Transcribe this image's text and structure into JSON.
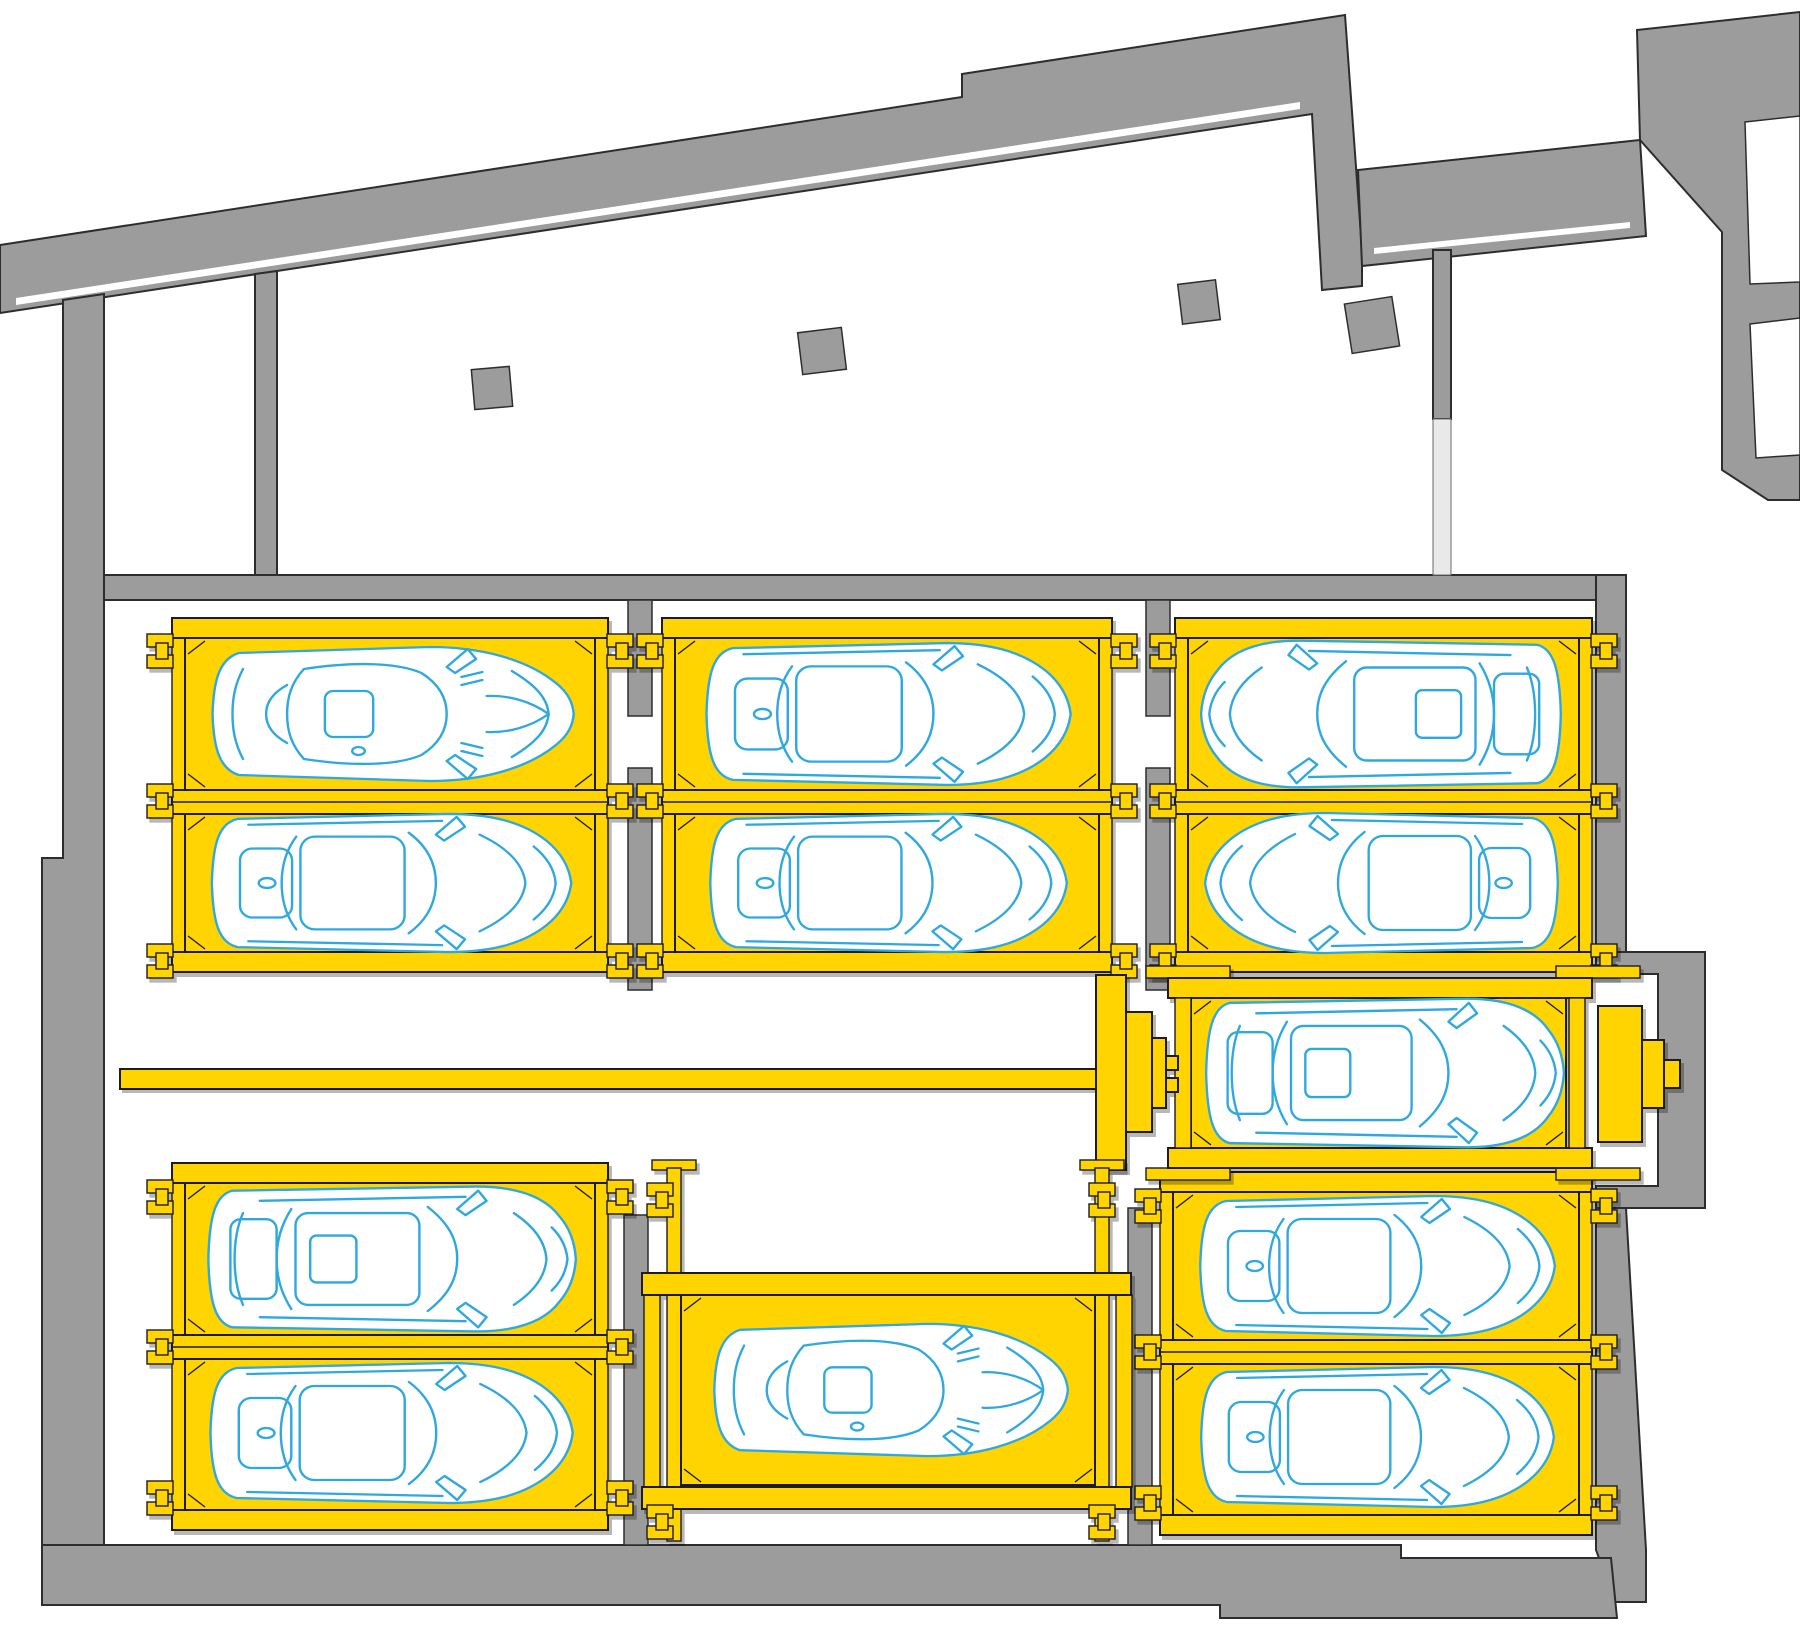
{
  "title": "automated-parking-system-floor-plan",
  "canvas": {
    "width": 1800,
    "height": 1641,
    "background": "#ffffff"
  },
  "colors": {
    "wall": "#9c9c9c",
    "wall_stroke": "#2d2d2d",
    "platform_yellow": "#ffd400",
    "platform_outline": "#1a1a1a",
    "car_line": "#2fa8df",
    "car_fill": "#ffffff",
    "door_opening": "#e9e9e9"
  },
  "structure": {
    "walls": [
      {
        "name": "perimeter-band-northwest",
        "points": "0,245 962,97 962,74 1345,15 1362,250 1362,286 1322,290 1312,114 0,313"
      },
      {
        "name": "band-north-horizontal",
        "points": "1358,170 1640,140 1646,236 1362,266"
      },
      {
        "name": "northeast-block",
        "points": "1637,30 1800,12 1800,500 1768,500 1722,470 1722,232 1640,140"
      },
      {
        "name": "niche-east-wall",
        "points": "255,274 277,271 277,600 255,600"
      },
      {
        "name": "west-wall",
        "points": "63,300 104,294 104,1605 42,1605 42,858 63,858"
      },
      {
        "name": "hall-north-wall",
        "points": "104,575 1596,575 1596,600 104,600"
      },
      {
        "name": "door-head-wall",
        "points": "1433,250 1451,250 1451,419 1433,419"
      },
      {
        "name": "east-wall-upper",
        "points": "1596,575 1626,575 1626,952 1596,952"
      },
      {
        "name": "east-wall-alcove",
        "points": "1596,952 1705,952 1705,1208 1596,1208 1596,1186 1658,1186 1658,974 1596,974"
      },
      {
        "name": "east-wall-lower",
        "points": "1596,1208 1626,1208 1646,1550 1646,1602 1615,1602 1596,1550"
      },
      {
        "name": "south-wall",
        "points": "42,1545 1401,1545 1401,1558 1611,1558 1617,1618 1220,1618 1220,1605 42,1605"
      }
    ],
    "wall_inner_lines": [
      {
        "name": "band-nw-inner-face",
        "points": "16,298 1300,102 1300,109 16,305"
      },
      {
        "name": "band-ne-inner-face",
        "points": "1374,248 1630,222 1630,228 1374,254"
      }
    ],
    "rooms": [
      {
        "name": "room-northeast-upper",
        "points": "1745,122 1800,116 1800,282 1750,284"
      },
      {
        "name": "room-northeast-lower",
        "points": "1750,324 1800,318 1800,455 1756,458"
      }
    ],
    "door_opening": {
      "x": 1433,
      "y": 419,
      "w": 18,
      "h": 156
    },
    "pillars": [
      [
        628,
        600,
        24,
        116
      ],
      [
        628,
        768,
        24,
        222
      ],
      [
        1146,
        600,
        24,
        116
      ],
      [
        1146,
        768,
        24,
        222
      ],
      [
        624,
        1215,
        24,
        330
      ],
      [
        1128,
        1208,
        24,
        337
      ]
    ],
    "tilted_columns": [
      [
        473,
        368,
        38,
        40,
        -5
      ],
      [
        800,
        330,
        44,
        42,
        -7
      ],
      [
        1180,
        282,
        38,
        40,
        -7
      ],
      [
        1348,
        300,
        48,
        50,
        -9
      ]
    ]
  },
  "parking": {
    "car_count": 12,
    "pallet_count": 12,
    "transfer_rail": {
      "x": 120,
      "y": 1069,
      "w": 984,
      "h": 20
    },
    "groups": [
      {
        "id": "upper-left",
        "x": 172,
        "w": 436,
        "top": [
          618,
          20
        ],
        "divider": [
          790,
          24
        ],
        "bottom": [
          952,
          20
        ],
        "rail_w": 13,
        "clamp_ys": [
          651,
          801,
          961
        ],
        "clamp_sides": [
          "left",
          "right"
        ]
      },
      {
        "id": "upper-middle",
        "x": 662,
        "w": 450,
        "top": [
          618,
          20
        ],
        "divider": [
          790,
          24
        ],
        "bottom": [
          952,
          20
        ],
        "rail_w": 13,
        "clamp_ys": [
          651,
          801,
          961
        ],
        "clamp_sides": [
          "left",
          "right"
        ]
      },
      {
        "id": "upper-right",
        "x": 1175,
        "w": 417,
        "top": [
          618,
          20
        ],
        "divider": [
          790,
          24
        ],
        "bottom": [
          952,
          20
        ],
        "rail_w": 13,
        "clamp_ys": [
          651,
          801,
          961
        ],
        "clamp_sides": [
          "left",
          "right"
        ]
      },
      {
        "id": "lower-left",
        "x": 172,
        "w": 436,
        "top": [
          1163,
          20
        ],
        "divider": [
          1335,
          24
        ],
        "bottom": [
          1510,
          20
        ],
        "rail_w": 13,
        "clamp_ys": [
          1197,
          1347,
          1498
        ],
        "clamp_sides": [
          "left",
          "right"
        ]
      },
      {
        "id": "lower-right",
        "x": 1160,
        "w": 432,
        "top": [
          1172,
          20
        ],
        "divider": [
          1340,
          24
        ],
        "bottom": [
          1515,
          20
        ],
        "rail_w": 13,
        "clamp_ys": [
          1206,
          1352,
          1503
        ],
        "clamp_sides": [
          "left",
          "right"
        ]
      }
    ],
    "transfer_platform": {
      "id": "transfer-platform",
      "x": 1168,
      "w": 424,
      "top_bar": [
        978,
        20
      ],
      "bottom_bar": [
        1148,
        20
      ],
      "rail_w": 16,
      "pallet": [
        1191,
        998,
        375,
        150
      ],
      "plates": [
        [
          1146,
          966,
          84,
          12
        ],
        [
          1146,
          1168,
          84,
          12
        ],
        [
          1556,
          966,
          84,
          12
        ],
        [
          1556,
          1168,
          84,
          12
        ]
      ]
    },
    "lower_middle_platform": {
      "id": "lower-middle",
      "posts": [
        [
          667,
          1168,
          14,
          373
        ],
        [
          1095,
          1168,
          14,
          373
        ]
      ],
      "post_caps": [
        [
          652,
          1160,
          44,
          10
        ],
        [
          1080,
          1160,
          44,
          10
        ]
      ],
      "cross_bars": [
        [
          642,
          1273,
          489,
          22
        ],
        [
          642,
          1487,
          489,
          22
        ]
      ],
      "side_plates": [
        [
          644,
          1295,
          16,
          192
        ],
        [
          1116,
          1295,
          16,
          192
        ]
      ],
      "pallet": [
        681,
        1295,
        414,
        190
      ],
      "clamps": [
        [
          660,
          1200
        ],
        [
          1102,
          1200
        ],
        [
          660,
          1522
        ],
        [
          1102,
          1522
        ]
      ]
    },
    "machinery": {
      "left_blocks": [
        [
          1096,
          975,
          30,
          195
        ],
        [
          1126,
          1012,
          26,
          120
        ],
        [
          1152,
          1038,
          14,
          70
        ],
        [
          1166,
          1056,
          12,
          14
        ],
        [
          1166,
          1078,
          12,
          14
        ]
      ],
      "right_blocks": [
        [
          1598,
          1006,
          44,
          136
        ],
        [
          1642,
          1040,
          22,
          68
        ],
        [
          1664,
          1060,
          16,
          28
        ]
      ]
    },
    "cars": [
      {
        "id": "car-1",
        "group": "upper-left",
        "type": "sport",
        "cx": 390,
        "cy": 714,
        "dir": "right",
        "length": 378,
        "width": 150
      },
      {
        "id": "car-2",
        "group": "upper-left",
        "type": "sedan",
        "cx": 390,
        "cy": 883,
        "dir": "right",
        "length": 375,
        "width": 148
      },
      {
        "id": "car-3",
        "group": "upper-middle",
        "type": "sedan",
        "cx": 887,
        "cy": 714,
        "dir": "right",
        "length": 380,
        "width": 152
      },
      {
        "id": "car-4",
        "group": "upper-middle",
        "type": "sedan",
        "cx": 887,
        "cy": 883,
        "dir": "right",
        "length": 372,
        "width": 148
      },
      {
        "id": "car-5",
        "group": "upper-right",
        "type": "suv",
        "cx": 1383,
        "cy": 714,
        "dir": "left",
        "length": 370,
        "width": 155
      },
      {
        "id": "car-6",
        "group": "upper-right",
        "type": "sedan",
        "cx": 1383,
        "cy": 883,
        "dir": "left",
        "length": 368,
        "width": 150
      },
      {
        "id": "car-7",
        "group": "transfer-platform",
        "type": "suv",
        "cx": 1383,
        "cy": 1073,
        "dir": "right",
        "length": 368,
        "width": 157
      },
      {
        "id": "car-8",
        "group": "lower-left",
        "type": "suv",
        "cx": 390,
        "cy": 1259,
        "dir": "right",
        "length": 378,
        "width": 153
      },
      {
        "id": "car-9",
        "group": "lower-left",
        "type": "sedan",
        "cx": 390,
        "cy": 1433,
        "dir": "right",
        "length": 378,
        "width": 150
      },
      {
        "id": "car-10",
        "group": "lower-middle",
        "type": "sport",
        "cx": 888,
        "cy": 1390,
        "dir": "right",
        "length": 370,
        "width": 148
      },
      {
        "id": "car-11",
        "group": "lower-right",
        "type": "sedan",
        "cx": 1376,
        "cy": 1266,
        "dir": "right",
        "length": 370,
        "width": 150
      },
      {
        "id": "car-12",
        "group": "lower-right",
        "type": "sedan",
        "cx": 1376,
        "cy": 1437,
        "dir": "right",
        "length": 368,
        "width": 150
      }
    ]
  }
}
